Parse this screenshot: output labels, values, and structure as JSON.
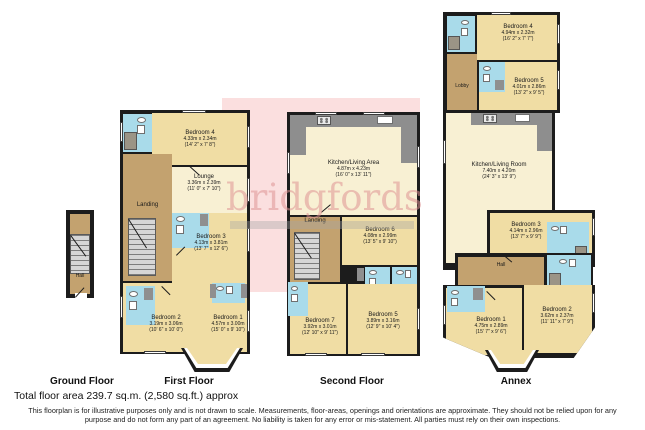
{
  "watermark": {
    "text": "bridgfords"
  },
  "floors": {
    "ground": {
      "label": "Ground Floor",
      "rooms": {
        "hall": {
          "name": "Hall"
        }
      }
    },
    "first": {
      "label": "First Floor",
      "rooms": {
        "bedroom4": {
          "name": "Bedroom 4",
          "metric": "4.33m x 2.34m",
          "imperial": "(14' 2\" x 7' 8\")"
        },
        "lounge": {
          "name": "Lounge",
          "metric": "3.36m x 2.39m",
          "imperial": "(11' 0\" x 7' 10\")"
        },
        "landing": {
          "name": "Landing"
        },
        "bedroom3": {
          "name": "Bedroom 3",
          "metric": "4.13m x 3.81m",
          "imperial": "(13' 7\" x 12' 6\")"
        },
        "bedroom2": {
          "name": "Bedroom 2",
          "metric": "3.19m x 3.06m",
          "imperial": "(10' 6\" x 10' 0\")"
        },
        "bedroom1": {
          "name": "Bedroom 1",
          "metric": "4.57m x 3.00m",
          "imperial": "(15' 0\" x 9' 10\")"
        }
      }
    },
    "second": {
      "label": "Second Floor",
      "rooms": {
        "kitchen_living": {
          "name": "Kitchen/Living Area",
          "metric": "4.87m x 4.23m",
          "imperial": "(16' 0\" x 13' 11\")"
        },
        "landing": {
          "name": "Landing"
        },
        "bedroom6": {
          "name": "Bedroom 6",
          "metric": "4.08m x 2.99m",
          "imperial": "(13' 5\" x 9' 10\")"
        },
        "bedroom7": {
          "name": "Bedroom 7",
          "metric": "3.92m x 3.01m",
          "imperial": "(12' 10\" x 9' 11\")"
        },
        "bedroom5": {
          "name": "Bedroom 5",
          "metric": "3.89m x 3.16m",
          "imperial": "(12' 9\" x 10' 4\")"
        }
      }
    },
    "annex": {
      "label": "Annex",
      "rooms": {
        "bedroom4": {
          "name": "Bedroom 4",
          "metric": "4.94m x 2.32m",
          "imperial": "(16' 2\" x 7' 7\")"
        },
        "lobby": {
          "name": "Lobby"
        },
        "bedroom5": {
          "name": "Bedroom 5",
          "metric": "4.01m x 2.86m",
          "imperial": "(13' 2\" x 9' 5\")"
        },
        "kitchen_living": {
          "name": "Kitchen/Living Room",
          "metric": "7.40m x 4.20m",
          "imperial": "(24' 3\" x 13' 9\")"
        },
        "bedroom3": {
          "name": "Bedroom 3",
          "metric": "4.14m x 2.96m",
          "imperial": "(13' 7\" x 9' 9\")"
        },
        "hall": {
          "name": "Hall"
        },
        "bedroom1": {
          "name": "Bedroom 1",
          "metric": "4.75m x 2.89m",
          "imperial": "(15' 7\" x 9' 6\")"
        },
        "bedroom2": {
          "name": "Bedroom 2",
          "metric": "3.62m x 2.37m",
          "imperial": "(11' 11\" x 7' 9\")"
        }
      }
    }
  },
  "footer": {
    "total_area": "Total floor area 239.7 sq.m. (2,580 sq.ft.) approx",
    "disclaimer_line1": "This floorplan is for illustrative purposes only and is not drawn to scale. Measurements, floor-areas, openings and orientations are approximate. They should not be relied upon for any",
    "disclaimer_line2": "purpose and do not form any part of an agreement. No liability is taken for any error or mis-statement. All parties must rely on their own inspections."
  },
  "colors": {
    "wall": "#1c1c1c",
    "room_cream": "#f8f0d3",
    "room_tan": "#f0dda4",
    "hall_brown": "#c3a26f",
    "bathroom_blue": "#a9dbea",
    "watermark_box_pink": "#fbdfdf",
    "watermark_text_pink": "#de9494"
  }
}
